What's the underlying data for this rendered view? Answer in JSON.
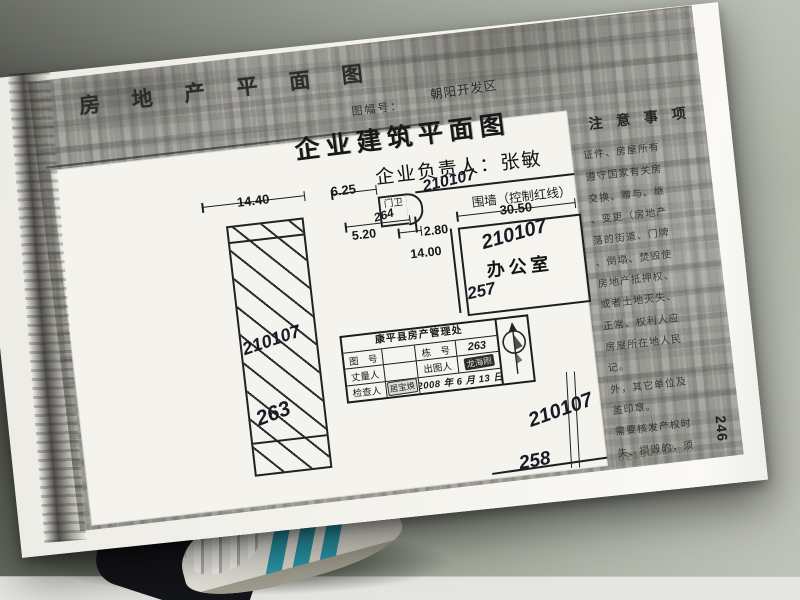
{
  "header": {
    "doc_title": "房 地 产 平 面 图",
    "sheet_no_label": "图幅号：",
    "sheet_no_value": "朝阳开发区"
  },
  "plan": {
    "title": "企业建筑平面图",
    "manager": "企业负责人：张敏",
    "wall_label": "围墙（控制红线）",
    "guard_label": "门卫",
    "office_label": "办公室",
    "dims": {
      "left_building_width": "14.40",
      "guard_width": "6.25",
      "guard_depth": "5.20",
      "gate_width": "2.80",
      "office_width": "30.50",
      "office_depth": "14.00"
    },
    "handwriting": {
      "left_building_parcel": "210107",
      "left_building_no": "263",
      "guard_parcel": "210107",
      "guard_no": "264",
      "office_parcel": "210107",
      "office_no": "257",
      "yard_parcel": "210107",
      "yard_no": "258"
    }
  },
  "notes": {
    "title": "注 意 事 项",
    "lines": [
      "证件、房屋所有",
      "遵守国家有关房",
      "交换、赠与、继",
      "、变更（房地产",
      "落的街道、门牌",
      "、倒塌、焚毁使",
      "房地产抵押权、",
      "或者土地灭失、",
      "正常、权利人应",
      "房屋所在地人民",
      "记。",
      "外，其它单位及",
      "盖印章。",
      "需要核发产权时",
      "失、损毁的，须"
    ]
  },
  "title_block": {
    "org": "康平县房产管理处",
    "row1": {
      "c1": "图　号",
      "c2": "",
      "c3": "栋　号",
      "c4": "263"
    },
    "row2": {
      "c1": "丈量人",
      "c2": "",
      "c3": "出图人",
      "c4": "龙海刚"
    },
    "row3": {
      "c1": "检查人",
      "c2": "居宝焕"
    },
    "date": "2008 年 6 月 13 日"
  },
  "page": {
    "page_number": "246",
    "archive_number": "02150712"
  },
  "colors": {
    "paper": "#f4f3ee",
    "copy_gray": "#a8a7a1",
    "ink": "#1c1c1c",
    "pen_ink": "#191a26",
    "shoe_stripe": "#2a9cae"
  }
}
